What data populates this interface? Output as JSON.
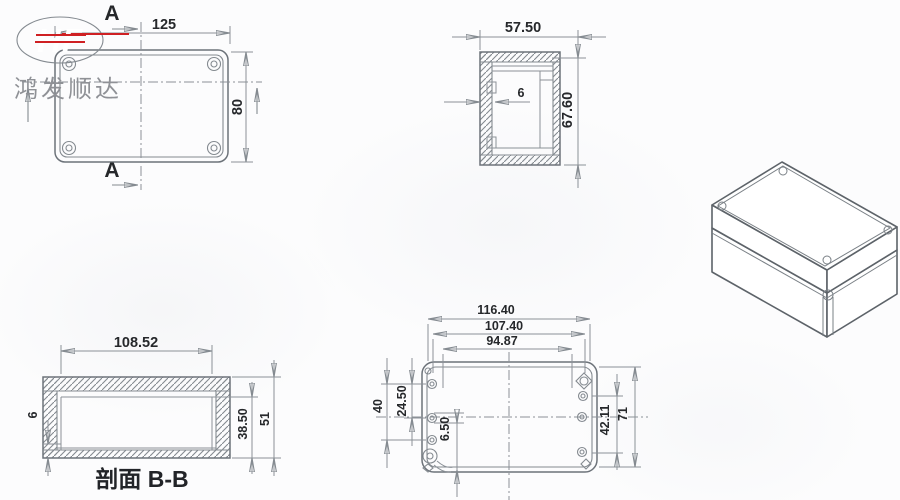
{
  "logo": {
    "brand": "HF",
    "company": "鸿发顺达",
    "badge_color": "#d02021"
  },
  "top_view": {
    "section_letter_top": "A",
    "section_letter_bottom": "A",
    "width": "125",
    "height": "80"
  },
  "side_view": {
    "width": "57.50",
    "height": "67.60",
    "wall": "6"
  },
  "section_view": {
    "caption": "剖面 B-B",
    "width": "108.52",
    "floor": "6",
    "depth_inner": "38.50",
    "depth_outer": "51"
  },
  "bottom_view": {
    "overall_width": "116.40",
    "screw_width": "107.40",
    "inner_width": "94.87",
    "left_outer": "40",
    "left_inner": "24.50",
    "hole_dia": "6.50",
    "right_inner": "42.11",
    "right_outer": "71"
  }
}
